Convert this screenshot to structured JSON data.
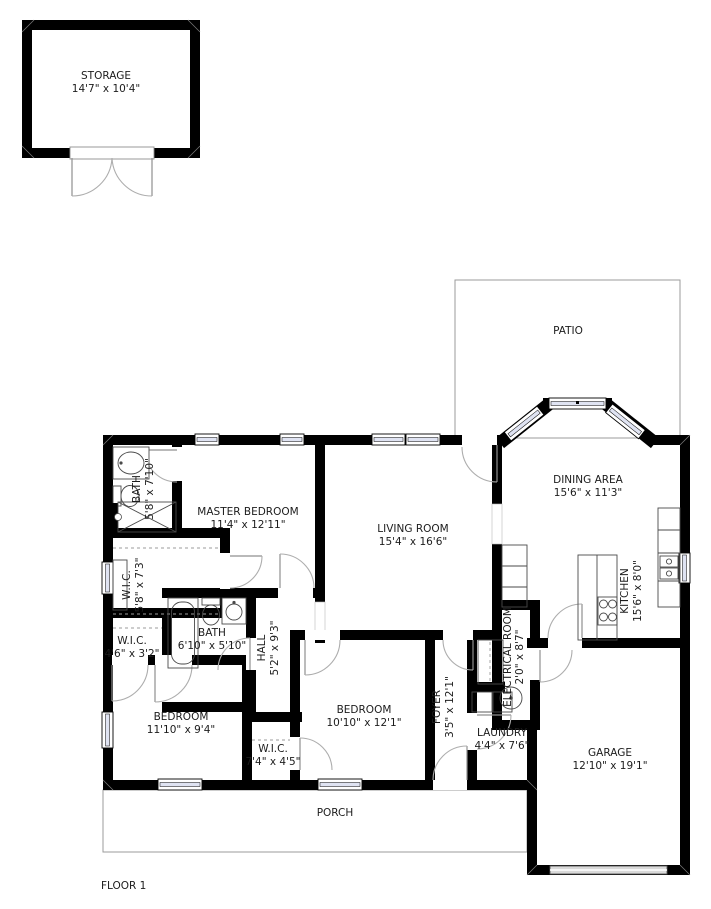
{
  "title": "FLOOR 1",
  "colors": {
    "wall": "#000000",
    "window_glass": "#dfe3f2",
    "outline_gray": "#9b9b9b"
  },
  "rooms": {
    "storage": {
      "name": "STORAGE",
      "dims": "14'7\" x 10'4\""
    },
    "patio": {
      "name": "PATIO",
      "dims": ""
    },
    "dining": {
      "name": "DINING AREA",
      "dims": "15'6\" x 11'3\""
    },
    "living": {
      "name": "LIVING ROOM",
      "dims": "15'4\" x 16'6\""
    },
    "master_bedroom": {
      "name": "MASTER BEDROOM",
      "dims": "11'4\" x 12'11\""
    },
    "master_bath": {
      "name": "BATH",
      "dims": "5'8\" x 7'10\""
    },
    "master_wic": {
      "name": "W.I.C.",
      "dims": "5'8\" x 7'3\""
    },
    "small_wic": {
      "name": "W.I.C.",
      "dims": "4'6\" x 3'2\""
    },
    "hall_bath": {
      "name": "BATH",
      "dims": "6'10\" x 5'10\""
    },
    "hall": {
      "name": "HALL",
      "dims": "5'2\" x 9'3\""
    },
    "bedroom_left": {
      "name": "BEDROOM",
      "dims": "11'10\" x 9'4\""
    },
    "bedroom_mid": {
      "name": "BEDROOM",
      "dims": "10'10\" x 12'1\""
    },
    "wic_bedroom": {
      "name": "W.I.C.",
      "dims": "7'4\" x 4'5\""
    },
    "foyer": {
      "name": "FOYER",
      "dims": "3'5\" x 12'1\""
    },
    "electrical": {
      "name": "ELECTRICAL ROOM",
      "dims": "2'0\" x 8'7\""
    },
    "laundry": {
      "name": "LAUNDRY",
      "dims": "4'4\" x 7'6\""
    },
    "kitchen": {
      "name": "KITCHEN",
      "dims": "15'6\" x 8'0\""
    },
    "garage": {
      "name": "GARAGE",
      "dims": "12'10\" x 19'1\""
    },
    "porch": {
      "name": "PORCH",
      "dims": ""
    }
  }
}
